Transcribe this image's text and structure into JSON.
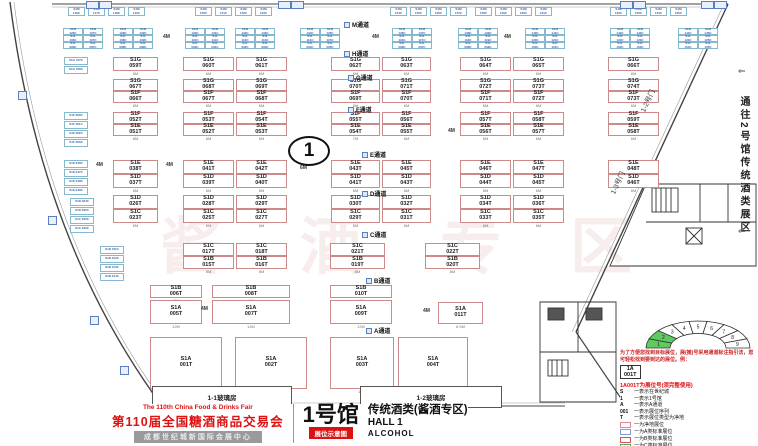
{
  "title_block": {
    "fair_en": "The 110th China Food & Drinks Fair",
    "fair_cn": "第110届全国糖酒商品交易会",
    "venue": "成都世纪城新国际会展中心",
    "hall_cn": "1号馆",
    "hall_tag": "展位示意图",
    "zone_cn": "传统酒类(酱酒专区)",
    "hall_en": "HALL 1",
    "hall_type_en": "ALCOHOL"
  },
  "side_note": {
    "text": "通往2号馆传统酒类展区",
    "arrow_top": "⇐",
    "arrow_bottom": "⇐"
  },
  "marker": {
    "circle_label": "1"
  },
  "watermark": [
    "酱",
    "酒",
    "专",
    "区"
  ],
  "doors": [
    {
      "label": "1-2号门",
      "x": 636,
      "y": 96
    },
    {
      "label": "1-3号门",
      "x": 606,
      "y": 178
    }
  ],
  "glass_rooms": [
    {
      "label": "1-1玻璃房",
      "x": 152,
      "y": 386,
      "w": 138,
      "h": 20
    },
    {
      "label": "1-2玻璃房",
      "x": 360,
      "y": 386,
      "w": 140,
      "h": 20
    }
  ],
  "aisles": [
    {
      "label": "M通道",
      "x": 344,
      "y": 20
    },
    {
      "label": "H通道",
      "x": 344,
      "y": 49
    },
    {
      "label": "G通道",
      "x": 348,
      "y": 73
    },
    {
      "label": "F通道",
      "x": 348,
      "y": 105
    },
    {
      "label": "E通道",
      "x": 362,
      "y": 150
    },
    {
      "label": "D通道",
      "x": 362,
      "y": 189
    },
    {
      "label": "C通道",
      "x": 362,
      "y": 230
    },
    {
      "label": "B通道",
      "x": 366,
      "y": 276
    },
    {
      "label": "A通道",
      "x": 366,
      "y": 326
    }
  ],
  "dims": [
    {
      "t": "4M",
      "x": 163,
      "y": 34
    },
    {
      "t": "4M",
      "x": 372,
      "y": 34
    },
    {
      "t": "4M",
      "x": 504,
      "y": 34
    },
    {
      "t": "4M",
      "x": 96,
      "y": 162
    },
    {
      "t": "4M",
      "x": 166,
      "y": 162
    },
    {
      "t": "4M",
      "x": 448,
      "y": 128
    },
    {
      "t": "4M",
      "x": 201,
      "y": 306
    },
    {
      "t": "4M",
      "x": 423,
      "y": 308
    },
    {
      "t": "6M",
      "x": 300,
      "y": 165
    }
  ],
  "top_markers": [
    86,
    99,
    278,
    291,
    620,
    633,
    701,
    714
  ],
  "left_markers": [
    [
      18,
      91
    ],
    [
      48,
      216
    ],
    [
      90,
      316
    ],
    [
      120,
      366
    ]
  ],
  "booths": [
    [
      "S1G 059T",
      113,
      57,
      45,
      14,
      "6M"
    ],
    [
      "S1G 060T",
      183,
      57,
      51,
      14,
      "6M"
    ],
    [
      "S1G 061T",
      236,
      57,
      51,
      14,
      "6M"
    ],
    [
      "S1G 062T",
      331,
      57,
      49,
      14,
      "6M"
    ],
    [
      "S1G 063T",
      382,
      57,
      49,
      14,
      "6M"
    ],
    [
      "S1G 064T",
      460,
      57,
      51,
      14,
      "6M"
    ],
    [
      "S1G 065T",
      513,
      57,
      51,
      14,
      "6M"
    ],
    [
      "S1G 066T",
      608,
      57,
      51,
      14,
      "6M"
    ],
    [
      "S1G 067T",
      113,
      79,
      45,
      12,
      "6M"
    ],
    [
      "S1G 068T",
      183,
      79,
      51,
      12,
      "6M"
    ],
    [
      "S1G 069T",
      236,
      79,
      51,
      12,
      "6M"
    ],
    [
      "S1G 070T",
      331,
      79,
      49,
      12,
      "6M"
    ],
    [
      "S1G 071T",
      382,
      79,
      49,
      12,
      "6M"
    ],
    [
      "S1G 072T",
      460,
      79,
      51,
      12,
      "6M"
    ],
    [
      "S1G 073T",
      513,
      79,
      51,
      12,
      "6M"
    ],
    [
      "S1G 074T",
      608,
      79,
      51,
      12,
      "6M"
    ],
    [
      "S1F 066T",
      113,
      91,
      45,
      12,
      "6M"
    ],
    [
      "S1F 067T",
      183,
      91,
      51,
      12,
      "6M"
    ],
    [
      "S1F 068T",
      236,
      91,
      51,
      12,
      "6M"
    ],
    [
      "S1F 069T",
      331,
      91,
      49,
      12,
      "6M"
    ],
    [
      "S1F 070T",
      382,
      91,
      49,
      12,
      "6M"
    ],
    [
      "S1F 071T",
      460,
      91,
      51,
      12,
      "6M"
    ],
    [
      "S1F 072T",
      513,
      91,
      51,
      12,
      "6M"
    ],
    [
      "S1F 073T",
      608,
      91,
      51,
      12,
      "6M"
    ],
    [
      "S1F 052T",
      113,
      112,
      45,
      12,
      "6M"
    ],
    [
      "S1F 053T",
      183,
      112,
      51,
      12,
      "6M"
    ],
    [
      "S1F 054T",
      236,
      112,
      51,
      12,
      "6M"
    ],
    [
      "S1F 055T",
      331,
      112,
      49,
      12,
      "7M"
    ],
    [
      "S1F 056T",
      382,
      112,
      49,
      12,
      "6M"
    ],
    [
      "S1F 057T",
      460,
      112,
      51,
      12,
      "6M"
    ],
    [
      "S1F 058T",
      513,
      112,
      51,
      12,
      "6M"
    ],
    [
      "S1F 059T",
      608,
      112,
      51,
      12,
      "6M"
    ],
    [
      "S1E 051T",
      113,
      124,
      45,
      12,
      "6M"
    ],
    [
      "S1E 052T",
      183,
      124,
      51,
      12,
      "6M"
    ],
    [
      "S1E 053T",
      236,
      124,
      51,
      12,
      "6M"
    ],
    [
      "S1E 054T",
      331,
      124,
      49,
      12,
      "7M"
    ],
    [
      "S1E 055T",
      382,
      124,
      49,
      12,
      "6M"
    ],
    [
      "S1E 056T",
      460,
      124,
      51,
      12,
      "6M"
    ],
    [
      "S1E 057T",
      513,
      124,
      51,
      12,
      "6M"
    ],
    [
      "S1E 058T",
      608,
      124,
      51,
      12,
      "6M"
    ],
    [
      "S1E 038T",
      113,
      160,
      45,
      14,
      "6M"
    ],
    [
      "S1E 041T",
      183,
      160,
      51,
      14,
      "6M"
    ],
    [
      "S1E 042T",
      236,
      160,
      51,
      14,
      "6M"
    ],
    [
      "S1E 043T",
      331,
      160,
      49,
      14,
      "6M"
    ],
    [
      "S1E 045T",
      382,
      160,
      49,
      14,
      "6M"
    ],
    [
      "S1E 046T",
      460,
      160,
      51,
      14,
      "6M"
    ],
    [
      "S1E 047T",
      513,
      160,
      51,
      14,
      "6M"
    ],
    [
      "S1E 048T",
      608,
      160,
      51,
      14,
      "6M"
    ],
    [
      "S1D 037T",
      113,
      174,
      45,
      14,
      "6M"
    ],
    [
      "S1D 039T",
      183,
      174,
      51,
      14,
      "6M"
    ],
    [
      "S1D 040T",
      236,
      174,
      51,
      14,
      "6M"
    ],
    [
      "S1D 041T",
      331,
      174,
      49,
      14,
      "6M"
    ],
    [
      "S1D 043T",
      382,
      174,
      49,
      14,
      "6M"
    ],
    [
      "S1D 044T",
      460,
      174,
      51,
      14,
      "6M"
    ],
    [
      "S1D 045T",
      513,
      174,
      51,
      14,
      "6M"
    ],
    [
      "S1D 046T",
      608,
      174,
      51,
      14,
      "6M"
    ],
    [
      "S1D 026T",
      113,
      195,
      45,
      14,
      "6M"
    ],
    [
      "S1D 028T",
      183,
      195,
      51,
      14,
      "6M"
    ],
    [
      "S1D 029T",
      236,
      195,
      51,
      14,
      "6M"
    ],
    [
      "S1D 030T",
      331,
      195,
      49,
      14,
      "6M"
    ],
    [
      "S1D 032T",
      382,
      195,
      49,
      14,
      "6M"
    ],
    [
      "S1D 034T",
      460,
      195,
      51,
      14,
      "6M"
    ],
    [
      "S1D 036T",
      513,
      195,
      51,
      14,
      "6M"
    ],
    [
      "S1C 023T",
      113,
      209,
      45,
      14,
      "6M"
    ],
    [
      "S1C 025T",
      183,
      209,
      51,
      14,
      "6M"
    ],
    [
      "S1C 027T",
      236,
      209,
      51,
      14,
      "6M"
    ],
    [
      "S1C 029T",
      331,
      209,
      49,
      14,
      "6M"
    ],
    [
      "S1C 031T",
      382,
      209,
      49,
      14,
      "6M"
    ],
    [
      "S1C 033T",
      460,
      209,
      51,
      14,
      "6M"
    ],
    [
      "S1C 035T",
      513,
      209,
      51,
      14,
      "6M"
    ],
    [
      "S1C 017T",
      183,
      243,
      51,
      13,
      "8M"
    ],
    [
      "S1C 018T",
      236,
      243,
      51,
      13,
      "8M"
    ],
    [
      "S1C 021T",
      330,
      243,
      55,
      13,
      "8M"
    ],
    [
      "S1C 022T",
      425,
      243,
      55,
      13,
      "8M"
    ],
    [
      "S1B 015T",
      183,
      256,
      51,
      13,
      "8M"
    ],
    [
      "S1B 016T",
      236,
      256,
      51,
      13,
      "8M"
    ],
    [
      "S1B 019T",
      330,
      256,
      55,
      13,
      "8M"
    ],
    [
      "S1B 020T",
      425,
      256,
      55,
      13,
      "8M"
    ],
    [
      "S1B 006T",
      150,
      285,
      52,
      13,
      "8M"
    ],
    [
      "S1B 008T",
      212,
      285,
      78,
      13,
      "16M"
    ],
    [
      "S1B 010T",
      330,
      285,
      62,
      13,
      "16M"
    ],
    [
      "S1A 005T",
      150,
      300,
      52,
      24,
      "12M"
    ],
    [
      "S1A 007T",
      212,
      300,
      78,
      24,
      "12M"
    ],
    [
      "S1A 009T",
      330,
      300,
      62,
      24,
      "12M"
    ],
    [
      "S1A 011T",
      438,
      302,
      45,
      22,
      "6.5M"
    ],
    [
      "S1A 001T",
      150,
      337,
      72,
      52,
      "10M"
    ],
    [
      "S1A 002T",
      235,
      337,
      72,
      52,
      "10M"
    ],
    [
      "S1A 003T",
      330,
      337,
      64,
      52,
      "10M"
    ],
    [
      "S1A 004T",
      398,
      337,
      70,
      52,
      "10M"
    ]
  ],
  "cyan_clusters": [
    {
      "x": 63,
      "rows": [
        [
          "S1M 126C",
          "S1M 127C"
        ],
        [
          "S1L 106C",
          "S1L 107C"
        ],
        [
          "S1L 086C",
          "S1L 087C"
        ]
      ]
    },
    {
      "x": 113,
      "rows": [
        [
          "S1M 128C",
          "S1M 129C"
        ],
        [
          "S1L 108C",
          "S1L 109C"
        ],
        [
          "S1L 088C",
          "S1L 089C"
        ]
      ]
    },
    {
      "x": 185,
      "rows": [
        [
          "S1M 130C",
          "S1M 131C"
        ],
        [
          "S1L 110C",
          "S1L 111C"
        ],
        [
          "S1L 090C",
          "S1L 091C"
        ]
      ]
    },
    {
      "x": 235,
      "rows": [
        [
          "S1M 132C",
          "S1M 133C"
        ],
        [
          "S1L 112C",
          "S1L 113C"
        ],
        [
          "S1L 092C",
          "S1L 093C"
        ]
      ]
    },
    {
      "x": 300,
      "rows": [
        [
          "S1M 134C",
          "S1M 135C"
        ],
        [
          "S1L 114C",
          "S1L 115C"
        ],
        [
          "S1L 094C",
          "S1L 095C"
        ]
      ]
    },
    {
      "x": 392,
      "rows": [
        [
          "S1M 136C",
          "S1M 137C"
        ],
        [
          "S1L 116C",
          "S1L 117C"
        ],
        [
          "S1L 096C",
          "S1L 097C"
        ]
      ]
    },
    {
      "x": 458,
      "rows": [
        [
          "S1M 138C",
          "S1M 139C"
        ],
        [
          "S1L 118C",
          "S1L 119C"
        ],
        [
          "S1L 098C",
          "S1L 099C"
        ]
      ]
    },
    {
      "x": 525,
      "rows": [
        [
          "S1M 140C",
          "S1M 141C"
        ],
        [
          "S1L 120C",
          "S1L 121C"
        ],
        [
          "S1L 100C",
          "S1L 101C"
        ]
      ]
    },
    {
      "x": 610,
      "rows": [
        [
          "S1M 142C",
          "S1M 143C"
        ],
        [
          "S1L 122C",
          "S1L 123C"
        ],
        [
          "S1L 102C",
          "S1L 103C"
        ]
      ]
    },
    {
      "x": 678,
      "rows": [
        [
          "S1M 144C",
          "S1M 145C"
        ],
        [
          "S1L 124C",
          "S1L 125C"
        ],
        [
          "S1L 104C",
          "S1L 105C"
        ]
      ]
    }
  ],
  "top_minis": [
    [
      "S1M 146C",
      68
    ],
    [
      "S1M 147C",
      88
    ],
    [
      "S1M 148C",
      108
    ],
    [
      "S1M 149C",
      128
    ],
    [
      "S1M 150C",
      195
    ],
    [
      "S1M 151C",
      215
    ],
    [
      "S1M 152C",
      235
    ],
    [
      "S1M 153C",
      255
    ],
    [
      "S1M 154C",
      390
    ],
    [
      "S1M 155C",
      410
    ],
    [
      "S1M 156C",
      430
    ],
    [
      "S1M 157C",
      450
    ],
    [
      "S1M 158C",
      475
    ],
    [
      "S1M 159C",
      495
    ],
    [
      "S1M 160C",
      515
    ],
    [
      "S1M 161C",
      535
    ],
    [
      "S1M 162C",
      610
    ],
    [
      "S1M 163C",
      630
    ],
    [
      "S1M 164C",
      650
    ],
    [
      "S1M 165C",
      670
    ]
  ],
  "left_minis": [
    [
      "S1G 077C",
      64,
      57
    ],
    [
      "S1G 078C",
      64,
      66
    ],
    [
      "S1F 060C",
      64,
      112
    ],
    [
      "S1F 061C",
      64,
      121
    ],
    [
      "S1F 062C",
      64,
      130
    ],
    [
      "S1F 063C",
      64,
      139
    ],
    [
      "S1E 046C",
      64,
      160
    ],
    [
      "S1E 047C",
      64,
      169
    ],
    [
      "S1E 048C",
      64,
      178
    ],
    [
      "S1E 049C",
      64,
      187
    ],
    [
      "S1D 034C",
      70,
      198
    ],
    [
      "S1D 035C",
      70,
      207
    ],
    [
      "S1C 032C",
      70,
      216
    ],
    [
      "S1C 033C",
      70,
      225
    ],
    [
      "S1B 011C",
      100,
      246
    ],
    [
      "S1B 012C",
      100,
      255
    ],
    [
      "S1B 013C",
      100,
      264
    ],
    [
      "S1B 014C",
      100,
      273
    ]
  ],
  "legend": {
    "intro": "为了方便您找到目标展位，展(摊)号采用通道标注指引法，您可轻松找到要到达的展位。例：",
    "example_top": "1A",
    "example_bottom": "001T",
    "headline": "1A001T为展位号(须完整使用)",
    "defs": [
      {
        "key": "S",
        "text": "一表示在世纪城"
      },
      {
        "key": "1",
        "text": "一表示1号馆"
      },
      {
        "key": "A",
        "text": "一表示A通道"
      },
      {
        "key": "001",
        "text": "一表示展位序列"
      },
      {
        "key": "T",
        "text": "一表示展位类型为净地"
      }
    ],
    "types": [
      {
        "color": "#dd8899",
        "label": "一为净地展位"
      },
      {
        "color": "#8899dd",
        "label": "一为A类标准展位"
      },
      {
        "color": "#cc5555",
        "label": "一为B类标准展位"
      },
      {
        "color": "#55aa66",
        "label": "一为C类标准展位"
      },
      {
        "color": "#66bbcc",
        "label": "一为D类标准展位"
      }
    ],
    "fire_box": "消火栓",
    "fire_note": "消防设施严禁遮挡"
  },
  "fan": {
    "segments": [
      {
        "n": "1",
        "g": true
      },
      {
        "n": "2",
        "g": true
      },
      {
        "n": "3"
      },
      {
        "n": "4"
      },
      {
        "n": "5"
      },
      {
        "n": "6"
      },
      {
        "n": "7"
      },
      {
        "n": "8"
      },
      {
        "n": "9"
      }
    ],
    "green": "#5ecb5e"
  }
}
